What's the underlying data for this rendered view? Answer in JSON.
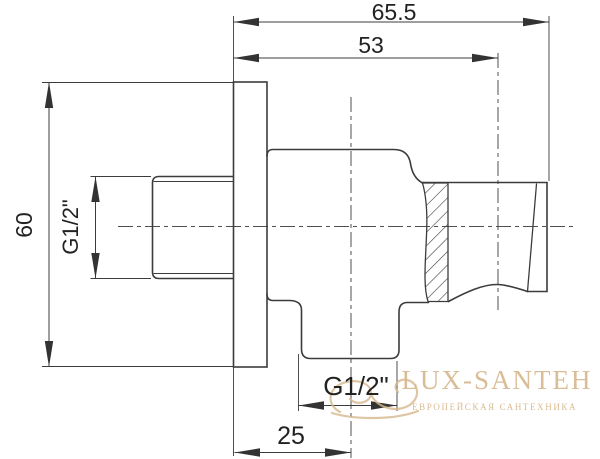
{
  "drawing": {
    "title_note": "shower outlet elbow with handset holder - dimensioned side view",
    "dimensions": {
      "width_full": "65.5",
      "width_to_holder_center": "53",
      "plate_height": "60",
      "inlet_thread": "G1/2\"",
      "outlet_thread": "G1/2\"",
      "outlet_offset": "25"
    },
    "colors": {
      "line": "#3c3c3c",
      "centerline": "#4f4f4f",
      "background": "#ffffff",
      "watermark": "#d6b88e"
    }
  },
  "watermark": {
    "brand": "LUX-SANTEH",
    "tagline": "ЕВРОПЕЙСКАЯ САНТЕХНИКА"
  }
}
